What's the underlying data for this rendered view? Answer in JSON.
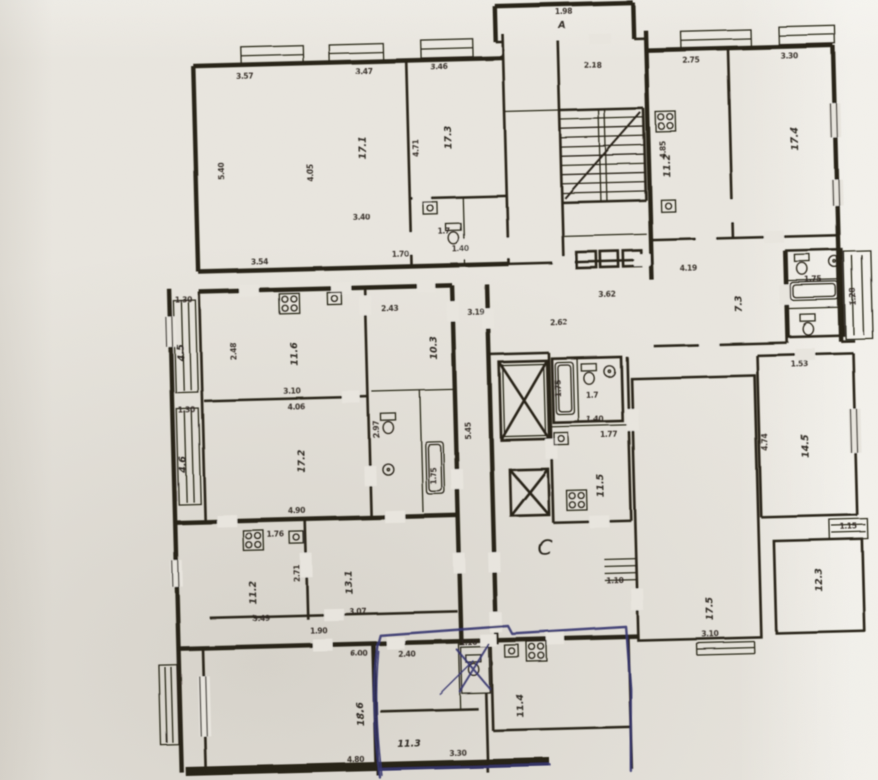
{
  "colors": {
    "paper": "#e9e6df",
    "ink": "#262019",
    "pen": "#35356e"
  },
  "plan": {
    "section_letter": "С",
    "rooms": [
      {
        "t": "17.1",
        "x": 372,
        "y": 152,
        "r": -90
      },
      {
        "t": "17.3",
        "x": 458,
        "y": 144,
        "r": -90
      },
      {
        "t": "А",
        "x": 572,
        "y": 38
      },
      {
        "t": "11.2",
        "x": 676,
        "y": 178,
        "r": -90
      },
      {
        "t": "17.4",
        "x": 804,
        "y": 154,
        "r": -90
      },
      {
        "t": "7.3",
        "x": 744,
        "y": 318,
        "r": -90
      },
      {
        "t": "11.6",
        "x": 298,
        "y": 356,
        "r": -90
      },
      {
        "t": "17.2",
        "x": 303,
        "y": 464,
        "r": -90
      },
      {
        "t": "10.3",
        "x": 438,
        "y": 354,
        "r": -90
      },
      {
        "t": "11.5",
        "x": 601,
        "y": 496,
        "r": -90
      },
      {
        "t": "17.5",
        "x": 707,
        "y": 622,
        "r": -90
      },
      {
        "t": "14.5",
        "x": 807,
        "y": 462,
        "r": -90
      },
      {
        "t": "12.3",
        "x": 817,
        "y": 596,
        "r": -90
      },
      {
        "t": "11.2",
        "x": 251,
        "y": 594,
        "r": -90
      },
      {
        "t": "13.1",
        "x": 347,
        "y": 586,
        "r": -90
      },
      {
        "t": "18.6",
        "x": 355,
        "y": 718,
        "r": -90
      },
      {
        "t": "11.4",
        "x": 515,
        "y": 714,
        "r": -90
      },
      {
        "t": "11.3",
        "x": 400,
        "y": 752
      },
      {
        "t": "4.5",
        "x": 185,
        "y": 352,
        "r": -90
      },
      {
        "t": "4.6",
        "x": 184,
        "y": 464,
        "r": -90
      }
    ],
    "dims": [
      {
        "t": "3.57",
        "x": 253,
        "y": 80
      },
      {
        "t": "3.47",
        "x": 372,
        "y": 78
      },
      {
        "t": "3.46",
        "x": 448,
        "y": 76
      },
      {
        "t": "1.98",
        "x": 574,
        "y": 24
      },
      {
        "t": "2.18",
        "x": 601,
        "y": 78
      },
      {
        "t": "2.75",
        "x": 700,
        "y": 76
      },
      {
        "t": "3.30",
        "x": 798,
        "y": 74
      },
      {
        "t": "5.40",
        "x": 230,
        "y": 172,
        "r": -90
      },
      {
        "t": "4.05",
        "x": 319,
        "y": 176,
        "r": -90
      },
      {
        "t": "4.71",
        "x": 425,
        "y": 154,
        "r": -90
      },
      {
        "t": "4.85",
        "x": 672,
        "y": 162,
        "r": -90
      },
      {
        "t": "3.40",
        "x": 366,
        "y": 224
      },
      {
        "t": "3.54",
        "x": 263,
        "y": 266
      },
      {
        "t": "1.70",
        "x": 404,
        "y": 262
      },
      {
        "t": "1.40",
        "x": 464,
        "y": 258
      },
      {
        "t": "1.7",
        "x": 448,
        "y": 240
      },
      {
        "t": "4.19",
        "x": 692,
        "y": 284
      },
      {
        "t": "3.62",
        "x": 610,
        "y": 308
      },
      {
        "t": "2.43",
        "x": 392,
        "y": 316
      },
      {
        "t": "3.19",
        "x": 478,
        "y": 322
      },
      {
        "t": "2.62",
        "x": 560,
        "y": 334
      },
      {
        "t": "1.30",
        "x": 186,
        "y": 302
      },
      {
        "t": "1.30",
        "x": 186,
        "y": 412
      },
      {
        "t": "2.48",
        "x": 237,
        "y": 352,
        "r": -90
      },
      {
        "t": "3.10",
        "x": 292,
        "y": 396
      },
      {
        "t": "4.06",
        "x": 296,
        "y": 412
      },
      {
        "t": "4.90",
        "x": 294,
        "y": 516
      },
      {
        "t": "2.97",
        "x": 378,
        "y": 434,
        "r": -90
      },
      {
        "t": "1.75",
        "x": 434,
        "y": 482,
        "r": -90
      },
      {
        "t": "5.45",
        "x": 470,
        "y": 438,
        "r": -90
      },
      {
        "t": "1.75",
        "x": 561,
        "y": 398,
        "r": -90
      },
      {
        "t": "1.7",
        "x": 592,
        "y": 408
      },
      {
        "t": "1.40",
        "x": 594,
        "y": 432
      },
      {
        "t": "1.77",
        "x": 608,
        "y": 448
      },
      {
        "t": "1.53",
        "x": 800,
        "y": 382
      },
      {
        "t": "4.74",
        "x": 766,
        "y": 457,
        "r": -90
      },
      {
        "t": "1.28",
        "x": 858,
        "y": 314,
        "r": -90
      },
      {
        "t": "1.75",
        "x": 816,
        "y": 298
      },
      {
        "t": "1.15",
        "x": 845,
        "y": 546
      },
      {
        "t": "1.76",
        "x": 272,
        "y": 539
      },
      {
        "t": "2.71",
        "x": 295,
        "y": 576,
        "r": -90
      },
      {
        "t": "3.49",
        "x": 255,
        "y": 622
      },
      {
        "t": "3.07",
        "x": 352,
        "y": 618
      },
      {
        "t": "6.00",
        "x": 352,
        "y": 660
      },
      {
        "t": "4.80",
        "x": 346,
        "y": 766
      },
      {
        "t": "2.40",
        "x": 400,
        "y": 662
      },
      {
        "t": "1.10",
        "x": 462,
        "y": 652
      },
      {
        "t": "3.30",
        "x": 448,
        "y": 762
      },
      {
        "t": "3.10",
        "x": 704,
        "y": 650
      },
      {
        "t": "1.90",
        "x": 312,
        "y": 636
      },
      {
        "t": "1.10",
        "x": 610,
        "y": 594
      }
    ],
    "fixtures": [
      {
        "k": "stove",
        "x": 663,
        "y": 124
      },
      {
        "k": "stove",
        "x": 282,
        "y": 296
      },
      {
        "k": "stove",
        "x": 564,
        "y": 500
      },
      {
        "k": "stove",
        "x": 240,
        "y": 532
      },
      {
        "k": "stove",
        "x": 520,
        "y": 650
      },
      {
        "k": "sink",
        "x": 666,
        "y": 212
      },
      {
        "k": "sink",
        "x": 330,
        "y": 296
      },
      {
        "k": "sink",
        "x": 553,
        "y": 442
      },
      {
        "k": "sink",
        "x": 286,
        "y": 534
      },
      {
        "k": "sink",
        "x": 498,
        "y": 653
      },
      {
        "k": "sink",
        "x": 428,
        "y": 208
      },
      {
        "k": "toilet",
        "x": 450,
        "y": 230
      },
      {
        "k": "toilet",
        "x": 380,
        "y": 418
      },
      {
        "k": "toilet",
        "x": 582,
        "y": 374
      },
      {
        "k": "toilet",
        "x": 798,
        "y": 270
      },
      {
        "k": "toilet",
        "x": 802,
        "y": 330
      },
      {
        "k": "toilet",
        "x": 459,
        "y": 662
      },
      {
        "k": "basin",
        "x": 380,
        "y": 468
      },
      {
        "k": "basin",
        "x": 604,
        "y": 376
      },
      {
        "k": "basin",
        "x": 832,
        "y": 272
      },
      {
        "k": "tubv",
        "x": 424,
        "y": 448
      },
      {
        "k": "tubv",
        "x": 556,
        "y": 372
      },
      {
        "k": "tubh",
        "x": 793,
        "y": 298
      }
    ]
  }
}
